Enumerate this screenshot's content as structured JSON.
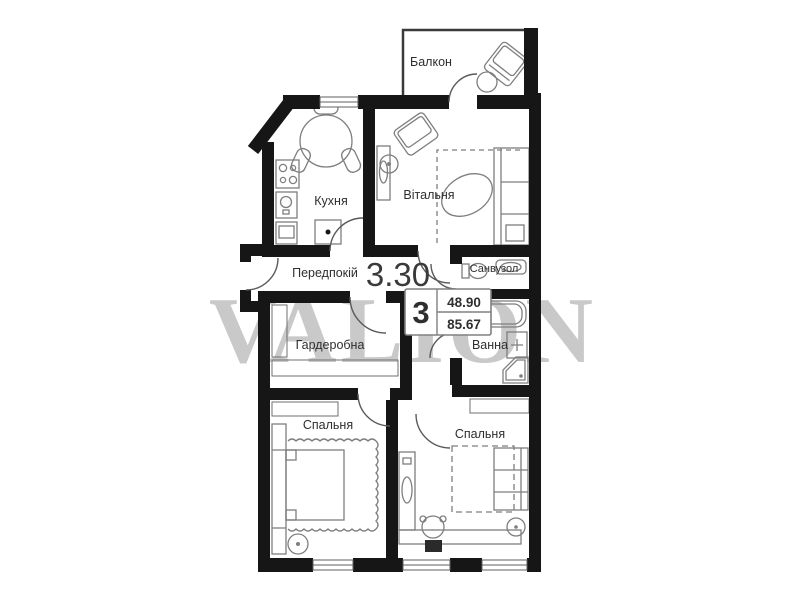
{
  "plan": {
    "watermark": "VALION",
    "height_mark": "3.30",
    "stamp": {
      "rooms_count": "3",
      "area_top": "48.90",
      "area_bottom": "85.67"
    },
    "rooms": {
      "balcony": {
        "label": "Балкон"
      },
      "kitchen": {
        "label": "Кухня"
      },
      "living_room": {
        "label": "Вітальня"
      },
      "hallway": {
        "label": "Передпокій"
      },
      "wc": {
        "label": "Санвузол"
      },
      "wardrobe": {
        "label": "Гардеробна"
      },
      "bathroom": {
        "label": "Ванна"
      },
      "bedroom_left": {
        "label": "Спальня"
      },
      "bedroom_right": {
        "label": "Спальня"
      }
    },
    "colors": {
      "walls": "#161616",
      "furniture": "#7e7e7e",
      "text": "#2e2e2e",
      "watermark": "#c9c9c9",
      "background": "#ffffff"
    }
  }
}
